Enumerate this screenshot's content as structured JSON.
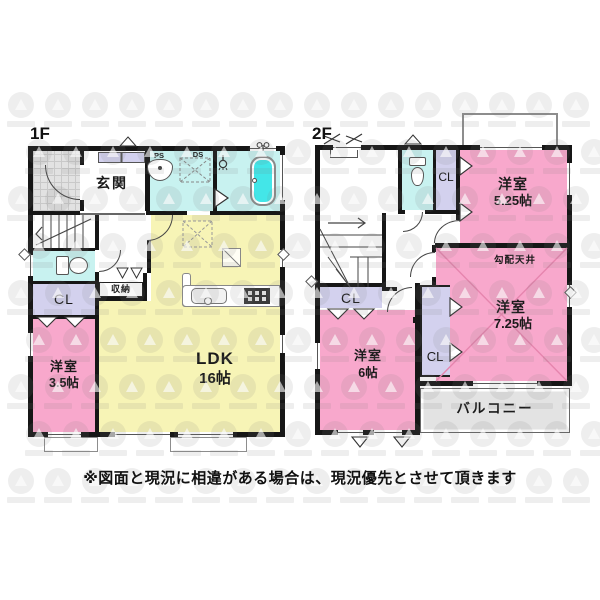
{
  "page": {
    "type": "floor-plan",
    "disclaimer": "※図面と現況に相違がある場合は、現況優先とさせて頂きます"
  },
  "floor1": {
    "label": "1F",
    "rooms": {
      "genkan": {
        "name": "玄関"
      },
      "ldk": {
        "name": "LDK",
        "size": "16帖"
      },
      "western35": {
        "name": "洋室",
        "size": "3.5帖"
      },
      "storage": {
        "name": "収納"
      },
      "closet": {
        "label": "CL"
      },
      "ps": "PS",
      "ds": "DS"
    }
  },
  "floor2": {
    "label": "2F",
    "rooms": {
      "western525": {
        "name": "洋室",
        "size": "5.25帖"
      },
      "western725": {
        "name": "洋室",
        "size": "7.25帖",
        "ceiling_note": "勾配天井"
      },
      "western6": {
        "name": "洋室",
        "size": "6帖"
      },
      "closet": {
        "label": "CL"
      },
      "balcony": {
        "name": "バルコニー"
      }
    }
  },
  "colors": {
    "room_pink": "#f8a8cc",
    "room_yellow": "#f7f4b6",
    "water_cyan": "#c8f2f0",
    "bathtub_cyan": "#43e6e8",
    "closet_lavender": "#d3d1ee",
    "balcony_gray": "#e3e3e3",
    "wall_black": "#161616"
  },
  "icons": [
    "bathtub-icon",
    "toilet-icon",
    "washbasin-icon",
    "kitchen-sink-icon",
    "stove-icon",
    "refrigerator-icon",
    "stairs-icon",
    "door-arc",
    "window",
    "vent-triangle",
    "shutter-mark"
  ]
}
